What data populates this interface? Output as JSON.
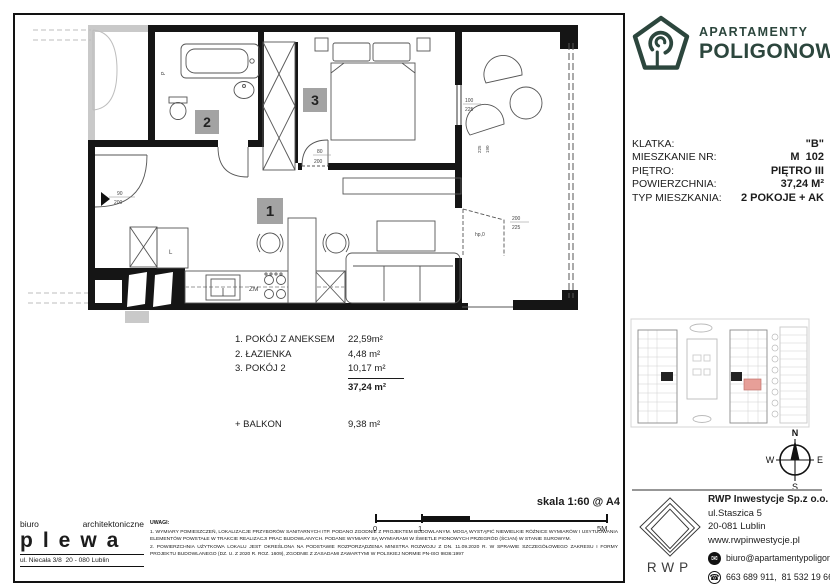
{
  "brand": {
    "line1": "APARTAMENTY",
    "line2": "POLIGONOWA"
  },
  "colors": {
    "brand_green": "#2c463d",
    "unit_highlight": "#e79f98",
    "room_label_gray": "#a3a3a3"
  },
  "unit": {
    "rows": [
      {
        "label": "KLATKA:",
        "value": "\"B\""
      },
      {
        "label": "MIESZKANIE NR:",
        "value": "M  102"
      },
      {
        "label": "PIĘTRO:",
        "value": "PIĘTRO III"
      },
      {
        "label": "POWIERZCHNIA:",
        "value": "37,24 M²"
      },
      {
        "label": "TYP MIESZKANIA:",
        "value": "2 POKOJE + AK"
      }
    ]
  },
  "rooms": {
    "items": [
      {
        "name": "1. POKÓJ Z ANEKSEM",
        "area": "22,59m²"
      },
      {
        "name": "2. ŁAZIENKA",
        "area": "4,48 m²"
      },
      {
        "name": "3. POKÓJ 2",
        "area": "10,17 m²"
      }
    ],
    "total": "37,24 m²",
    "balcony_label": "+ BALKON",
    "balcony_area": "9,38 m²"
  },
  "plan": {
    "labels": {
      "r1": "1",
      "r2": "2",
      "r3": "3"
    },
    "texts": {
      "zm": "ZM",
      "p": "P",
      "hp": "hp,0",
      "l": "L"
    },
    "dims": {
      "entry_a": "90",
      "entry_b": "200",
      "r3_a": "80",
      "r3_b": "200",
      "win_a": "100",
      "win_b": "225",
      "door_a": "200",
      "door_b": "225",
      "v1": "225",
      "v2": "190"
    }
  },
  "scale": {
    "label": "skala 1:60 @ A4",
    "t0": "0",
    "t1": "1",
    "t2": "5M"
  },
  "notes": {
    "title": "UWAGI:",
    "p1": "1. WYMIARY POMIESZCZEŃ, LOKALIZACJE PRZYBORÓW SANITARNYCH ITP. PODANO ZGODNIE Z PROJEKTEM BUDOWLANYM. MOGĄ WYSTĄPIĆ NIEWIELKIE RÓŻNICE WYMIARÓW I USYTUOWANIA ELEMENTÓW POWSTAŁE W TRAKCIE REALIZACJI PRAC BUDOWLANYCH. PODANE WYMIARY SĄ WYMIARAMI W ŚWIETLE PIONOWYCH PRZEGRÓD (ŚCIAN) W STANIE SUROWYM.",
    "p2": "2. POWIERZCHNIA UŻYTKOWA LOKALU JEST OKREŚLONA NA PODSTAWIE ROZPORZĄDZENIA MINISTRA ROZWOJU Z DN. 11.09.2020 R. W SPRAWIE SZCZEGÓŁOWEGO ZAKRESU I FORMY PROJEKTU BUDOWLANEGO (DZ. U. Z 2020 R. ROZ. 1609), ZGODNIE Z ZASADAMI ZAWARTYMI W POLSKIEJ NORMIE PN-ISO 9836:1997"
  },
  "architect": {
    "word1": "biuro",
    "word2": "architektoniczne",
    "name": "plewa",
    "address": "ul. Niecała 3/8  20 - 080 Lublin"
  },
  "compass": {
    "n": "N",
    "s": "S",
    "e": "E",
    "w": "W"
  },
  "developer": {
    "logo_text": "RWP",
    "company": "RWP Inwestycje Sp.z o.o.",
    "street": "ul.Staszica 5",
    "city": "20-081 Lublin",
    "website": "www.rwpinwestycje.pl",
    "email": "biuro@apartamentypoligonowa.pl",
    "phones": "663 689 911,  81 532 19 66"
  }
}
